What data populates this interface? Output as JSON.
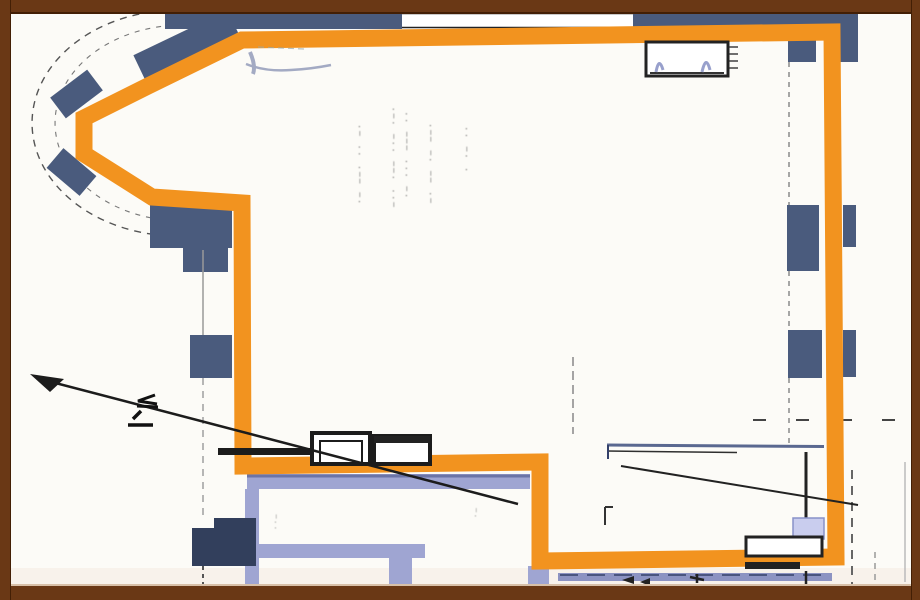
{
  "meta": {
    "description_of_page": "scanned architectural floor plan with orange highlighted unit outline"
  },
  "colors": {
    "paper": "#FCFBF7",
    "tint": "#F4EBE2",
    "orange": "#F2931F",
    "wallBlue": "#4A5B7D",
    "wallBlueDark": "#323F5C",
    "lavender": "#9FA5D2",
    "lavenderLight": "#C9CDEE",
    "lavenderDark": "#6B74A6",
    "frame": "#6A3815",
    "frameDark": "#431F05",
    "frameLight": "#D8C0A8",
    "ink": "#1C1C1C",
    "gray": "#8A8A8A",
    "roomLine": "#5A6890",
    "smudge": "#7E88AE"
  },
  "elements": {
    "highlight_outline": "orange-highlighted-unit-boundary",
    "bay_window": "curved-bay-window-top-left",
    "section_arrow": "diagonal-section-arrow",
    "window_fixture": "window-fixture-box-top-right",
    "door_frames": "double-door-frames-bottom-center",
    "scan_frame": "dark-brown-scan-border"
  },
  "annotations": {
    "center_text": {
      "cols": [
        {
          "text": "·— ——· ·· —·"
        },
        {
          "text": "—·· ·—— ··— ·—·"
        },
        {
          "text": "·— ··· ——— ··"
        },
        {
          "text": "—· —— ·— ——·"
        },
        {
          "text": "· ·— ··"
        },
        {
          "text": "··—"
        },
        {
          "text": "·—"
        }
      ]
    }
  }
}
